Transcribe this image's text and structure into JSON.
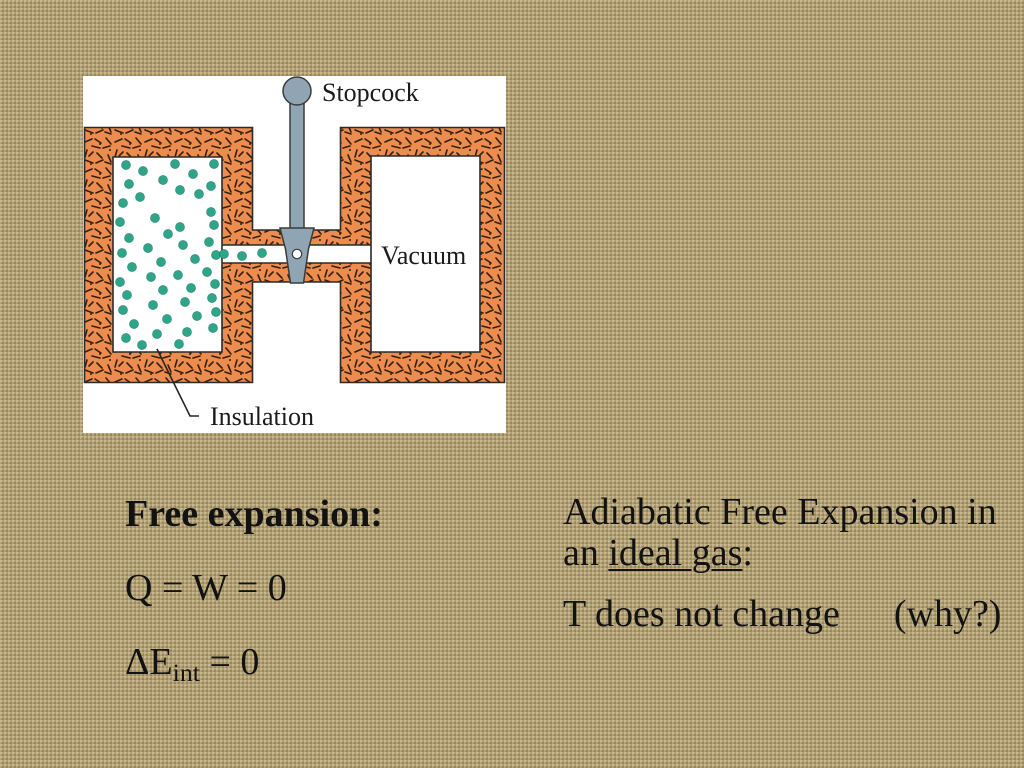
{
  "slide": {
    "background_color": "#b3a072",
    "text_color": "#121212"
  },
  "figure": {
    "description": "free-expansion apparatus diagram",
    "labels": {
      "stopcock": "Stopcock",
      "vacuum": "Vacuum",
      "insulation": "Insulation"
    },
    "colors": {
      "figure_bg": "#ffffff",
      "insulation": "#ec8c4e",
      "speckle": "#35210a",
      "gas_particle": "#2da588",
      "stopcock": "#90a5b4",
      "outline": "#2b2b2b"
    },
    "gas_particles": [
      [
        43,
        89
      ],
      [
        60,
        95
      ],
      [
        92,
        88
      ],
      [
        131,
        88
      ],
      [
        46,
        108
      ],
      [
        80,
        104
      ],
      [
        110,
        98
      ],
      [
        128,
        110
      ],
      [
        40,
        127
      ],
      [
        57,
        121
      ],
      [
        97,
        114
      ],
      [
        116,
        118
      ],
      [
        37,
        146
      ],
      [
        72,
        142
      ],
      [
        97,
        151
      ],
      [
        128,
        136
      ],
      [
        46,
        162
      ],
      [
        85,
        158
      ],
      [
        131,
        149
      ],
      [
        39,
        177
      ],
      [
        65,
        172
      ],
      [
        100,
        169
      ],
      [
        126,
        166
      ],
      [
        49,
        191
      ],
      [
        78,
        186
      ],
      [
        112,
        183
      ],
      [
        133,
        179
      ],
      [
        37,
        206
      ],
      [
        68,
        201
      ],
      [
        95,
        199
      ],
      [
        124,
        196
      ],
      [
        44,
        219
      ],
      [
        80,
        214
      ],
      [
        108,
        212
      ],
      [
        132,
        208
      ],
      [
        40,
        234
      ],
      [
        70,
        229
      ],
      [
        102,
        226
      ],
      [
        129,
        222
      ],
      [
        51,
        248
      ],
      [
        84,
        243
      ],
      [
        114,
        240
      ],
      [
        133,
        236
      ],
      [
        43,
        262
      ],
      [
        74,
        258
      ],
      [
        104,
        256
      ],
      [
        130,
        252
      ],
      [
        59,
        269
      ],
      [
        96,
        268
      ]
    ],
    "channel_particles": [
      [
        141,
        178
      ],
      [
        159,
        180
      ],
      [
        179,
        177
      ]
    ]
  },
  "left_column": {
    "heading": "Free expansion:",
    "eq1": "Q = W = 0",
    "eq2_pre": "ΔE",
    "eq2_sub": "int",
    "eq2_post": " = 0"
  },
  "right_column": {
    "line1": "Adiabatic Free Expansion in",
    "line2_pre": "an ",
    "line2_underline": "ideal gas",
    "line2_post": ":",
    "line3_text": "T does not change",
    "line3_note": "(why?)"
  }
}
